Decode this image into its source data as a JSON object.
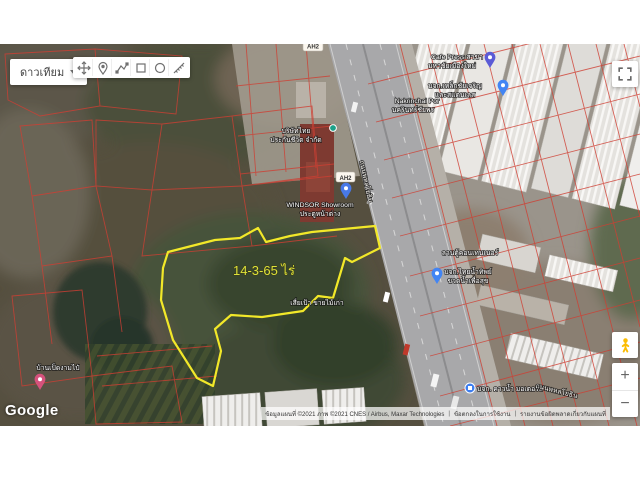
{
  "controls": {
    "satellite_button_label": "ดาวเทียม",
    "toolbar_icons": [
      "pan",
      "add-marker",
      "draw-line",
      "draw-shape",
      "draw-circle",
      "measure"
    ],
    "zoom_in_label": "+",
    "zoom_out_label": "−",
    "google_logo": "Google"
  },
  "map": {
    "area_label": "14-3-65 ไร่",
    "road_shield": "AH2",
    "road_name": "ถนนพหลโยธิน",
    "labels": {
      "thai_life_1": "บริษัทไทย",
      "thai_life_2": "ประกันชีวิต จำกัด",
      "windsor_1": "WINDSOR Showroom",
      "windsor_2": "ประตูหน้าต่าง",
      "sia_pao": "เสี่ยเป้า ขายไม้เก่า",
      "nakrinchai_1": "Nakrinchai Por",
      "nakrinchai_2": "นครินทร์ชัยพร",
      "cafe_press_1": "Cafe Press สาขา",
      "cafe_press_2": "มหาชัยเมืองใหม่",
      "steel_co_1": "บจก.เหล็กชัยเจริญ",
      "steel_co_2": "และสแตนเลส",
      "container_yard": "ลานตู้คอนเทนเนอร์",
      "water_co_1": "บจก.ไทยน้ำทิพย์",
      "water_co_2": "ขวดน้ำเพื่อสุข",
      "motor_market": "บจก. คาวน้ำ มอเตอร์ส",
      "ban_ped": "บ้านเป็ดงามไป๋"
    },
    "colors": {
      "parcel_lines": "#cf3f33",
      "highlight_outline": "#f2e829",
      "area_label_text": "#dde23b"
    }
  },
  "attribution": {
    "copyright": "ข้อมูลแผนที่ ©2021 ภาพ ©2021 CNES / Airbus, Maxar Technologies",
    "terms": "ข้อตกลงในการใช้งาน",
    "report_error": "รายงานข้อผิดพลาดเกี่ยวกับแผนที่"
  }
}
